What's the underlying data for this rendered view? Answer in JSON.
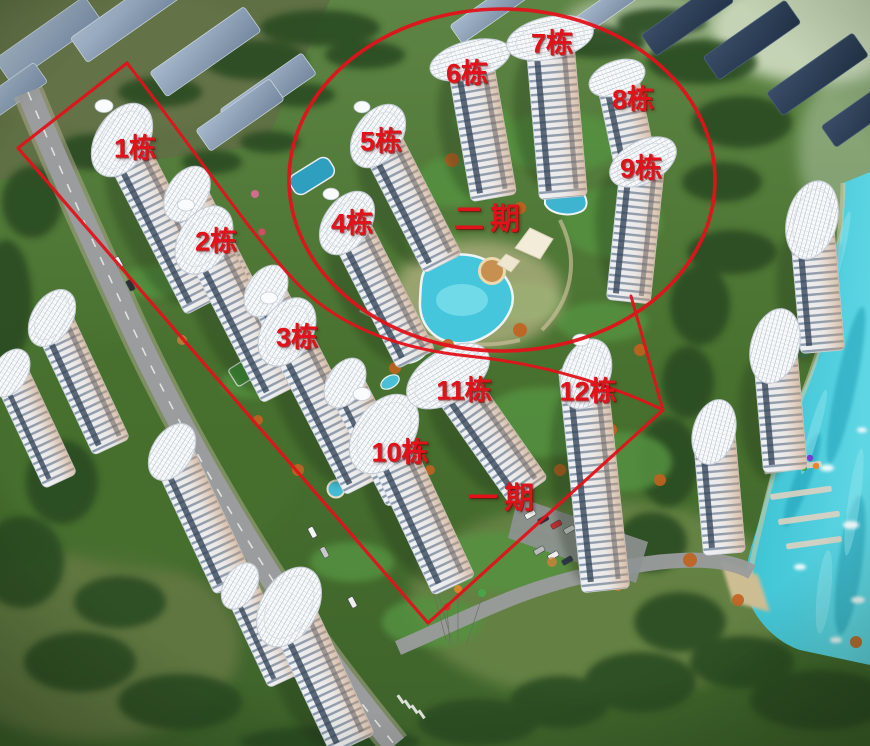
{
  "labels": {
    "b1": "1栋",
    "b2": "2栋",
    "b3": "3栋",
    "b4": "4栋",
    "b5": "5栋",
    "b6": "6栋",
    "b7": "7栋",
    "b8": "8栋",
    "b9": "9栋",
    "b10": "10栋",
    "b11": "11栋",
    "b12": "12栋",
    "phase1": "一期",
    "phase2": "二期"
  },
  "phase_regions": {
    "phase1": {
      "label": "一期",
      "buildings": [
        "1栋",
        "2栋",
        "3栋",
        "10栋",
        "11栋",
        "12栋"
      ]
    },
    "phase2": {
      "label": "二期",
      "buildings": [
        "4栋",
        "5栋",
        "6栋",
        "7栋",
        "8栋",
        "9栋"
      ]
    }
  },
  "palette": {
    "annotation_red": "#e2121b",
    "lake_teal": "#2fb8cc",
    "pool_cyan": "#46c6dc",
    "lawn_green": "#4e7a38",
    "tree_dark_green": "#2a4c20",
    "road_gray": "#9a9c9d",
    "tower_facade": "#edf0f4",
    "glass_blue": "#2e4156",
    "rooftop_slab_blue": "#8fa3ba",
    "sand_tan": "#d9c9a0"
  }
}
